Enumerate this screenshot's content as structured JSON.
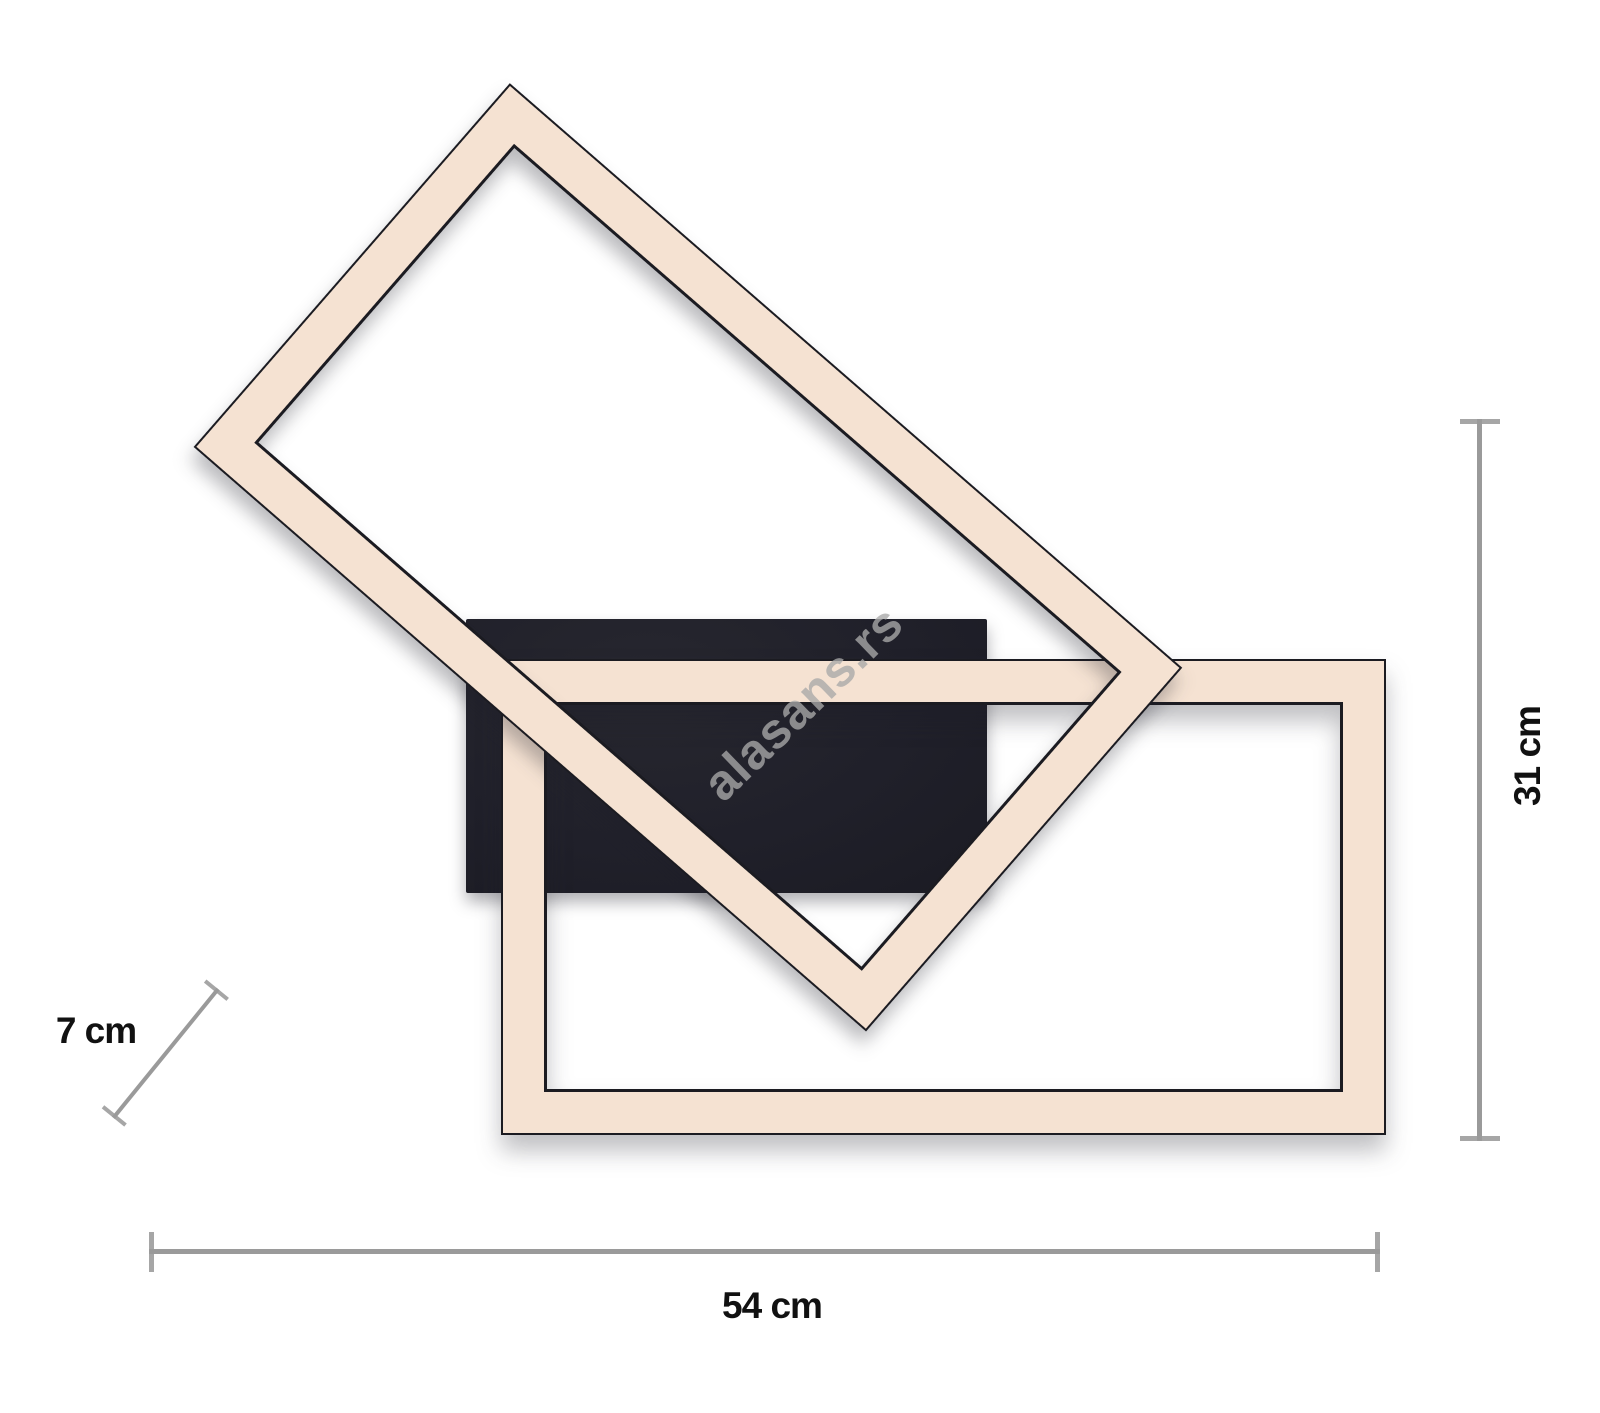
{
  "watermark": {
    "text": "alasans.rs"
  },
  "dimensions": {
    "width": {
      "label": "54 cm"
    },
    "height": {
      "label": "31 cm"
    },
    "depth": {
      "label": "7 cm"
    }
  },
  "colors": {
    "background": "#ffffff",
    "frame_fill": "#f5e2d2",
    "frame_outline": "#1b1b21",
    "mounting_plate": "#20202a",
    "dimension_line": "#9a9a9a",
    "dimension_text": "#111111",
    "watermark": "#a9a9a9"
  }
}
